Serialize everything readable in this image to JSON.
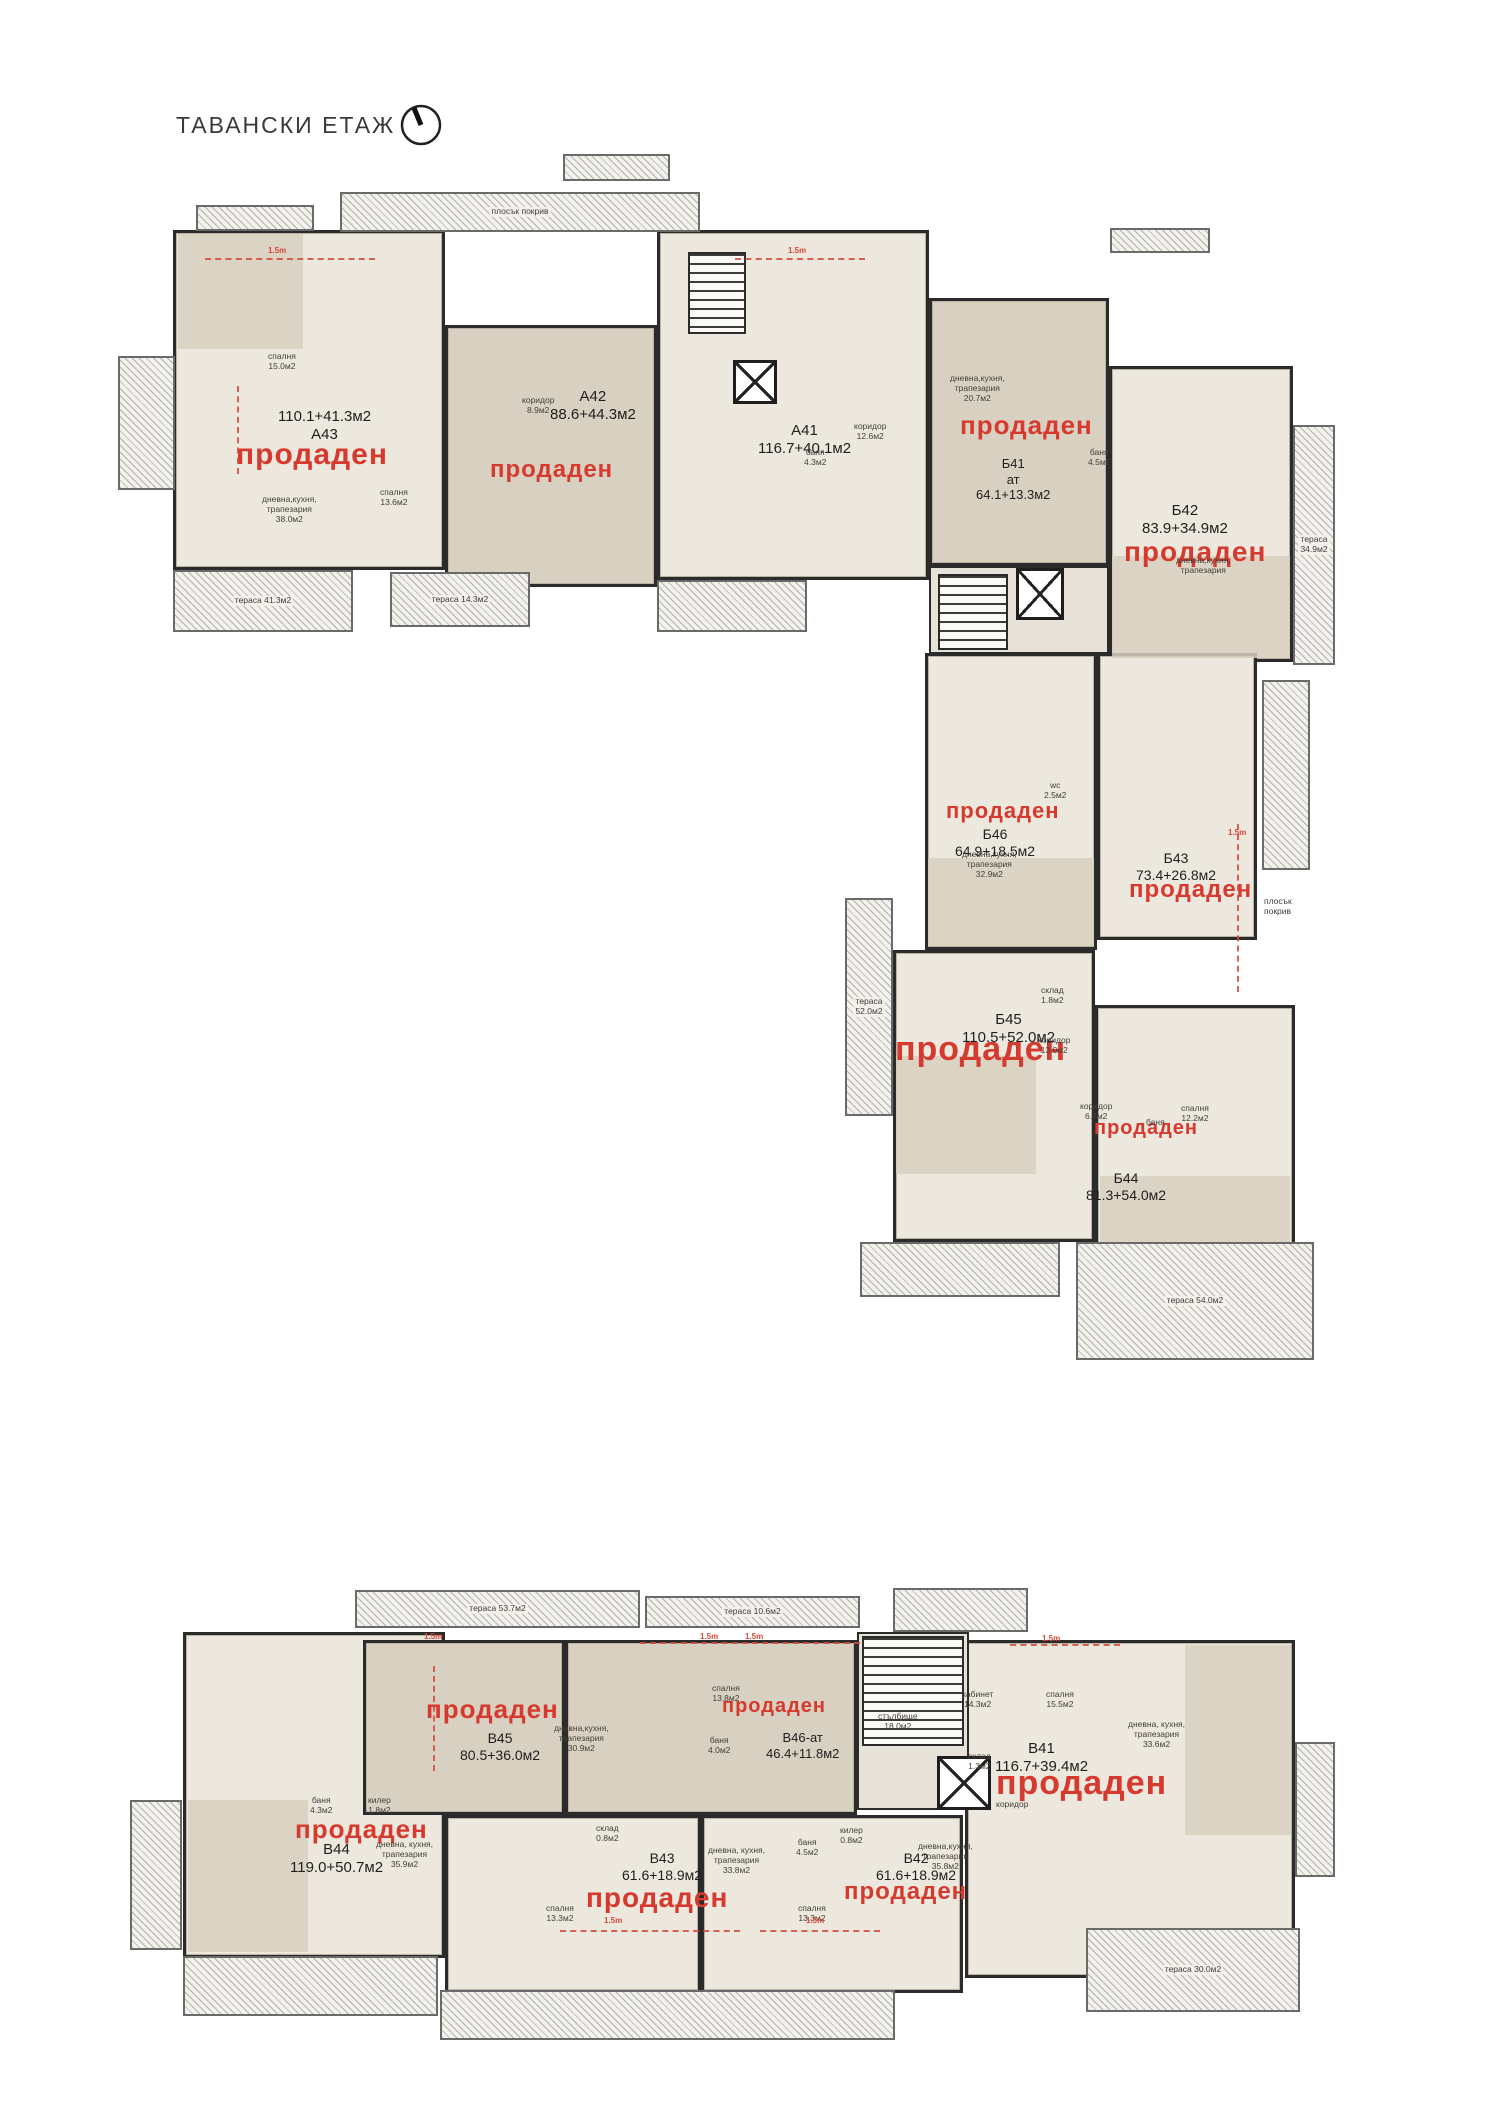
{
  "page": {
    "title": "ТАВАНСКИ ЕТАЖ"
  },
  "shared": {
    "sold_text": "продаден"
  },
  "icons": {
    "compass": "north-arrow-icon"
  },
  "plans": {
    "upper": {
      "name": "Тавански етаж — горен корпус",
      "units": [
        {
          "id": "А43",
          "area": "110.1+41.3м2",
          "sold": true,
          "tone": "light",
          "area_first": true,
          "box": [
            173,
            230,
            272,
            340
          ],
          "label_at": [
            278,
            408
          ],
          "label_px": 15,
          "sold_at": [
            236,
            440
          ],
          "sold_px": 30
        },
        {
          "id": "А42",
          "area": "88.6+44.3м2",
          "sold": true,
          "tone": "dark",
          "box": [
            445,
            325,
            212,
            262
          ],
          "label_at": [
            550,
            388
          ],
          "label_px": 15,
          "sold_at": [
            490,
            458
          ],
          "sold_px": 24
        },
        {
          "id": "А41",
          "area": "116.7+40.1м2",
          "sold": false,
          "tone": "light",
          "box": [
            657,
            230,
            272,
            350
          ],
          "label_at": [
            758,
            422
          ],
          "label_px": 15
        },
        {
          "id": "Б41",
          "sub": "ат",
          "area": "64.1+13.3м2",
          "sold": true,
          "tone": "dark",
          "box": [
            929,
            298,
            180,
            268
          ],
          "label_at": [
            976,
            456
          ],
          "label_px": 13,
          "sold_at": [
            960,
            412
          ],
          "sold_px": 26
        },
        {
          "id": "Б42",
          "area": "83.9+34.9м2",
          "sold": true,
          "tone": "light",
          "box": [
            1109,
            366,
            184,
            296
          ],
          "label_at": [
            1142,
            502
          ],
          "label_px": 15,
          "sold_at": [
            1124,
            538
          ],
          "sold_px": 28
        },
        {
          "id": "Б46",
          "area": "64.9+18.5м2",
          "sold": true,
          "tone": "light",
          "box": [
            925,
            653,
            172,
            297
          ],
          "label_at": [
            955,
            826
          ],
          "label_px": 14,
          "sold_at": [
            946,
            800
          ],
          "sold_px": 22
        },
        {
          "id": "Б43",
          "area": "73.4+26.8м2",
          "sold": true,
          "tone": "light",
          "box": [
            1097,
            653,
            160,
            287
          ],
          "label_at": [
            1136,
            850
          ],
          "label_px": 14,
          "sold_at": [
            1129,
            878
          ],
          "sold_px": 24
        },
        {
          "id": "Б45",
          "area": "110.5+52.0м2",
          "sold": true,
          "tone": "light",
          "box": [
            893,
            950,
            202,
            292
          ],
          "label_at": [
            962,
            1011
          ],
          "label_px": 15,
          "sold_at": [
            895,
            1032
          ],
          "sold_px": 34
        },
        {
          "id": "Б44",
          "area": "81.3+54.0м2",
          "sold": true,
          "tone": "light",
          "box": [
            1095,
            1005,
            200,
            288
          ],
          "label_at": [
            1086,
            1170
          ],
          "label_px": 14,
          "sold_at": [
            1094,
            1118
          ],
          "sold_px": 20
        }
      ],
      "terraces": [
        {
          "box": [
            340,
            192,
            360,
            40
          ],
          "label": "плосък покрив"
        },
        {
          "box": [
            118,
            356,
            57,
            134
          ]
        },
        {
          "box": [
            173,
            570,
            180,
            62
          ],
          "label": "тераса 41.3м2"
        },
        {
          "box": [
            390,
            572,
            140,
            55
          ],
          "label": "тераса 14.3м2"
        },
        {
          "box": [
            657,
            580,
            150,
            52
          ]
        },
        {
          "box": [
            1293,
            425,
            42,
            240
          ],
          "label": "тераса\n34.9м2"
        },
        {
          "box": [
            1262,
            680,
            48,
            190
          ]
        },
        {
          "box": [
            845,
            898,
            48,
            218
          ],
          "label": "тераса\n52.0м2"
        },
        {
          "box": [
            1076,
            1242,
            238,
            118
          ],
          "label": "тераса 54.0м2"
        },
        {
          "box": [
            860,
            1242,
            200,
            55
          ]
        },
        {
          "box": [
            196,
            205,
            118,
            26
          ]
        },
        {
          "box": [
            563,
            154,
            107,
            27
          ]
        },
        {
          "box": [
            1110,
            228,
            100,
            25
          ]
        }
      ],
      "cores": [
        {
          "type": "stairs",
          "box": [
            688,
            252,
            58,
            82
          ]
        },
        {
          "type": "elevator",
          "box": [
            733,
            360,
            44,
            44
          ]
        },
        {
          "type": "corridor",
          "box": [
            929,
            566,
            180,
            88
          ]
        },
        {
          "type": "stairs",
          "box": [
            938,
            574,
            70,
            76
          ]
        },
        {
          "type": "elevator",
          "box": [
            1016,
            568,
            48,
            52
          ]
        }
      ],
      "patches": [
        {
          "box": [
            178,
            234,
            125,
            115
          ]
        },
        {
          "box": [
            1112,
            556,
            178,
            102
          ]
        },
        {
          "box": [
            928,
            858,
            166,
            88
          ]
        },
        {
          "box": [
            896,
            1056,
            140,
            118
          ]
        },
        {
          "box": [
            1100,
            1176,
            190,
            112
          ]
        }
      ],
      "rooms": [
        {
          "t": "спалня\n15.0м2",
          "at": [
            268,
            352
          ]
        },
        {
          "t": "дневна,кухня,\nтрапезария\n38.0м2",
          "at": [
            262,
            495
          ]
        },
        {
          "t": "спалня\n13.6м2",
          "at": [
            380,
            488
          ]
        },
        {
          "t": "коридор\n8.9м2",
          "at": [
            522,
            396
          ]
        },
        {
          "t": "коридор\n12.6м2",
          "at": [
            854,
            422
          ]
        },
        {
          "t": "баня\n4.3м2",
          "at": [
            804,
            448
          ]
        },
        {
          "t": "дневна,кухня,\nтрапезария\n20.7м2",
          "at": [
            950,
            374
          ]
        },
        {
          "t": "баня\n4.5м2",
          "at": [
            1088,
            448
          ]
        },
        {
          "t": "дневна,кухня,\nтрапезария",
          "at": [
            1176,
            556
          ]
        },
        {
          "t": "дневна,кухня,\nтрапезария\n32.9м2",
          "at": [
            962,
            850
          ]
        },
        {
          "t": "wc\n2.5м2",
          "at": [
            1044,
            781
          ]
        },
        {
          "t": "склад\n1.8м2",
          "at": [
            1041,
            986
          ]
        },
        {
          "t": "коридор\n13.0м2",
          "at": [
            1038,
            1036
          ]
        },
        {
          "t": "коридор\n6.8м2",
          "at": [
            1080,
            1102
          ]
        },
        {
          "t": "спалня\n12.2м2",
          "at": [
            1181,
            1104
          ]
        },
        {
          "t": "баня",
          "at": [
            1146,
            1118
          ]
        }
      ],
      "notes": [
        {
          "t": "плосък\nпокрив",
          "at": [
            1264,
            896
          ]
        }
      ],
      "markers": [
        {
          "text": "1.5m",
          "at": [
            268,
            246
          ]
        },
        {
          "text": "1.5m",
          "at": [
            788,
            246
          ]
        },
        {
          "text": "1.5m",
          "at": [
            1228,
            828
          ]
        }
      ],
      "dashes": [
        {
          "dir": "h",
          "at": [
            205,
            258
          ],
          "len": 170
        },
        {
          "dir": "h",
          "at": [
            735,
            258
          ],
          "len": 130
        },
        {
          "dir": "v",
          "at": [
            237,
            386
          ],
          "len": 88
        },
        {
          "dir": "v",
          "at": [
            1237,
            824
          ],
          "len": 168
        }
      ]
    },
    "lower": {
      "name": "Тавански етаж — долен корпус",
      "units": [
        {
          "id": "В44",
          "area": "119.0+50.7м2",
          "sold": true,
          "tone": "light",
          "box": [
            183,
            1632,
            262,
            326
          ],
          "label_at": [
            290,
            1841
          ],
          "label_px": 15,
          "sold_at": [
            295,
            1816
          ],
          "sold_px": 26
        },
        {
          "id": "В45",
          "area": "80.5+36.0м2",
          "sold": true,
          "tone": "dark",
          "box": [
            363,
            1640,
            202,
            175
          ],
          "label_at": [
            460,
            1730
          ],
          "label_px": 14,
          "sold_at": [
            426,
            1696
          ],
          "sold_px": 26
        },
        {
          "id": "В46-ат",
          "area": "46.4+11.8м2",
          "sold": true,
          "tone": "dark",
          "box": [
            565,
            1640,
            292,
            175
          ],
          "label_at": [
            766,
            1730
          ],
          "label_px": 13,
          "sold_at": [
            722,
            1696
          ],
          "sold_px": 20
        },
        {
          "id": "В41",
          "area": "116.7+39.4м2",
          "sold": true,
          "tone": "light",
          "box": [
            965,
            1640,
            330,
            338
          ],
          "label_at": [
            995,
            1740
          ],
          "label_px": 15,
          "sold_at": [
            996,
            1766
          ],
          "sold_px": 34
        },
        {
          "id": "В43",
          "area": "61.6+18.9м2",
          "sold": true,
          "tone": "light",
          "box": [
            445,
            1815,
            256,
            178
          ],
          "label_at": [
            622,
            1850
          ],
          "label_px": 14,
          "sold_at": [
            586,
            1884
          ],
          "sold_px": 28
        },
        {
          "id": "В42",
          "area": "61.6+18.9м2",
          "sold": true,
          "tone": "light",
          "box": [
            701,
            1815,
            262,
            178
          ],
          "label_at": [
            876,
            1850
          ],
          "label_px": 14,
          "sold_at": [
            844,
            1880
          ],
          "sold_px": 24
        }
      ],
      "terraces": [
        {
          "box": [
            355,
            1590,
            285,
            38
          ],
          "label": "тераса 53.7м2"
        },
        {
          "box": [
            645,
            1596,
            215,
            32
          ],
          "label": "тераса 10.6м2"
        },
        {
          "box": [
            893,
            1588,
            135,
            44
          ]
        },
        {
          "box": [
            183,
            1956,
            255,
            60
          ]
        },
        {
          "box": [
            440,
            1990,
            455,
            50
          ]
        },
        {
          "box": [
            1086,
            1928,
            214,
            84
          ],
          "label": "тераса 30.0м2"
        },
        {
          "box": [
            130,
            1800,
            52,
            150
          ]
        },
        {
          "box": [
            1295,
            1742,
            40,
            135
          ]
        }
      ],
      "cores": [
        {
          "type": "corridor",
          "box": [
            857,
            1632,
            112,
            178
          ]
        },
        {
          "type": "stairs",
          "box": [
            862,
            1636,
            102,
            110
          ]
        },
        {
          "type": "elevator",
          "box": [
            937,
            1756,
            54,
            54
          ]
        }
      ],
      "patches": [
        {
          "box": [
            188,
            1800,
            120,
            152
          ]
        },
        {
          "box": [
            1185,
            1645,
            106,
            190
          ]
        }
      ],
      "rooms": [
        {
          "t": "дневна,кухня,\nтрапезария\n30.9м2",
          "at": [
            554,
            1724
          ]
        },
        {
          "t": "спалня\n13.8м2",
          "at": [
            712,
            1684
          ]
        },
        {
          "t": "баня\n4.0м2",
          "at": [
            708,
            1736
          ]
        },
        {
          "t": "стълбище\n18.0м2",
          "at": [
            878,
            1712
          ]
        },
        {
          "t": "кабинет\n14.3м2",
          "at": [
            962,
            1690
          ]
        },
        {
          "t": "спалня\n15.5м2",
          "at": [
            1046,
            1690
          ]
        },
        {
          "t": "дневна, кухня,\nтрапезария\n33.6м2",
          "at": [
            1128,
            1720
          ]
        },
        {
          "t": "склад\n1.3м2",
          "at": [
            968,
            1752
          ]
        },
        {
          "t": "коридор",
          "at": [
            996,
            1800
          ]
        },
        {
          "t": "баня\n4.3м2",
          "at": [
            310,
            1796
          ]
        },
        {
          "t": "килер\n1.8м2",
          "at": [
            368,
            1796
          ]
        },
        {
          "t": "дневна, кухня,\nтрапезария\n35.9м2",
          "at": [
            376,
            1840
          ]
        },
        {
          "t": "склад\n0.8м2",
          "at": [
            596,
            1824
          ]
        },
        {
          "t": "дневна, кухня,\nтрапезария\n33.8м2",
          "at": [
            708,
            1846
          ]
        },
        {
          "t": "спалня\n13.3м2",
          "at": [
            546,
            1904
          ]
        },
        {
          "t": "килер\n0.8м2",
          "at": [
            840,
            1826
          ]
        },
        {
          "t": "баня\n4.5м2",
          "at": [
            796,
            1838
          ]
        },
        {
          "t": "дневна,кухня,\nтрапезария\n35.8м2",
          "at": [
            918,
            1842
          ]
        },
        {
          "t": "спалня\n13.3м2",
          "at": [
            798,
            1904
          ]
        }
      ],
      "notes": [],
      "markers": [
        {
          "text": "1.5m",
          "at": [
            424,
            1632
          ]
        },
        {
          "text": "1.5m",
          "at": [
            700,
            1632
          ]
        },
        {
          "text": "1.5m",
          "at": [
            745,
            1632
          ]
        },
        {
          "text": "1.5m",
          "at": [
            1042,
            1634
          ]
        },
        {
          "text": "1.5m",
          "at": [
            604,
            1916
          ]
        },
        {
          "text": "1.5m",
          "at": [
            806,
            1916
          ]
        }
      ],
      "dashes": [
        {
          "dir": "h",
          "at": [
            640,
            1642
          ],
          "len": 220
        },
        {
          "dir": "h",
          "at": [
            1010,
            1644
          ],
          "len": 110
        },
        {
          "dir": "v",
          "at": [
            433,
            1666
          ],
          "len": 105
        },
        {
          "dir": "h",
          "at": [
            560,
            1930
          ],
          "len": 180
        },
        {
          "dir": "h",
          "at": [
            760,
            1930
          ],
          "len": 120
        }
      ]
    }
  }
}
